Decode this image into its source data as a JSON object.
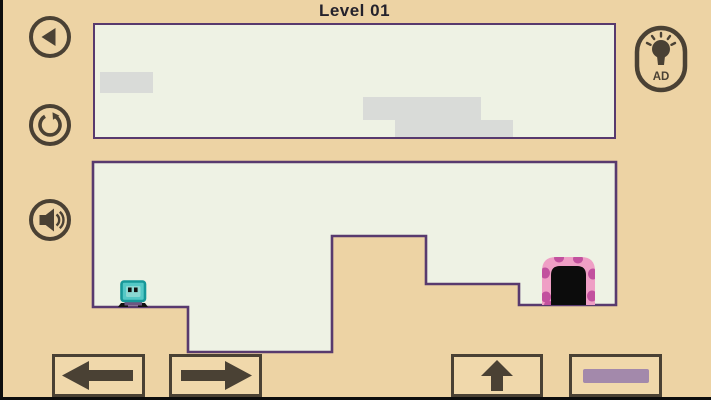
{
  "title": "Level 01",
  "hint_button": {
    "label": "AD",
    "icon": "lightbulb-icon"
  },
  "sidebar": {
    "items": [
      {
        "name": "back",
        "icon": "back-arrow-icon"
      },
      {
        "name": "restart",
        "icon": "restart-icon"
      },
      {
        "name": "sound",
        "icon": "speaker-icon"
      }
    ]
  },
  "controls": {
    "items": [
      {
        "name": "move-left",
        "icon": "left-arrow-icon"
      },
      {
        "name": "move-right",
        "icon": "right-arrow-icon"
      },
      {
        "name": "jump",
        "icon": "up-arrow-icon"
      },
      {
        "name": "dash",
        "icon": "dash-bar-icon"
      }
    ]
  },
  "game": {
    "character": "teal-box-robot",
    "exit": "pink-framed-door",
    "cloud_blocks": 3
  },
  "colors": {
    "background": "#edd3a4",
    "panel": "#eef2e4",
    "panel_border": "#583a6e",
    "icon_brown": "#4a4134",
    "cloud_gray": "#d9dbd8",
    "character_teal": "#54c8c6",
    "door_pink": "#ef9fc5",
    "door_spot": "#c2519e",
    "dash_bar": "#a389ab"
  }
}
